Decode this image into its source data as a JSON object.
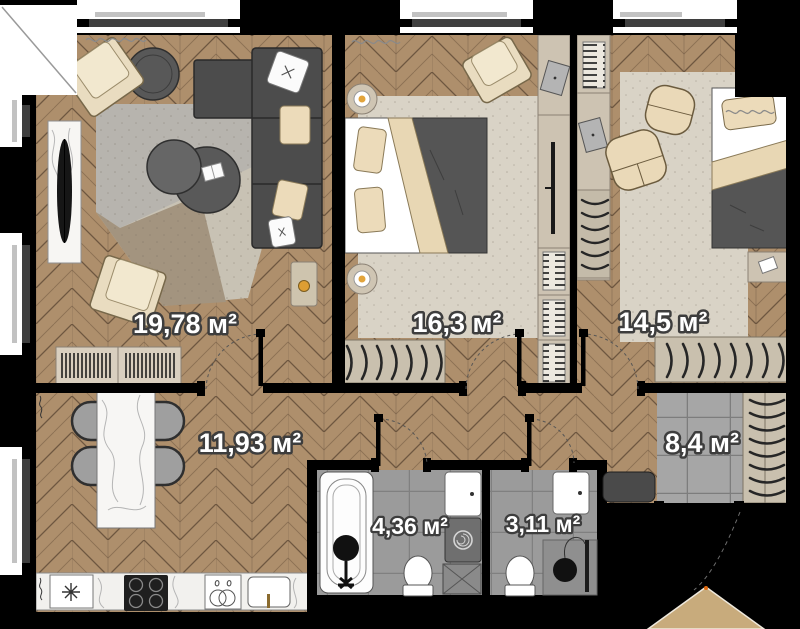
{
  "plan": {
    "title": "apartment-floor-plan",
    "area_unit": "м²",
    "rooms": [
      {
        "name": "living-room",
        "area_label": "19,78 м²"
      },
      {
        "name": "bedroom-1",
        "area_label": "16,3 м²"
      },
      {
        "name": "bedroom-2",
        "area_label": "14,5 м²"
      },
      {
        "name": "kitchen-dining",
        "area_label": "11,93 м²"
      },
      {
        "name": "hallway",
        "area_label": "8,4 м²"
      },
      {
        "name": "bathroom",
        "area_label": "4,36 м²"
      },
      {
        "name": "wc",
        "area_label": "3,11 м²"
      }
    ],
    "colors": {
      "wall": "#000000",
      "wood_floor": "#ae8f6c",
      "tile_floor": "#a3a3a3",
      "rug": "#d9d3c6",
      "furniture_dark": "#4c4c4c",
      "furniture_beige": "#e9dcc0",
      "label_text": "#ffffff",
      "label_outline": "#3d3d3d"
    }
  }
}
